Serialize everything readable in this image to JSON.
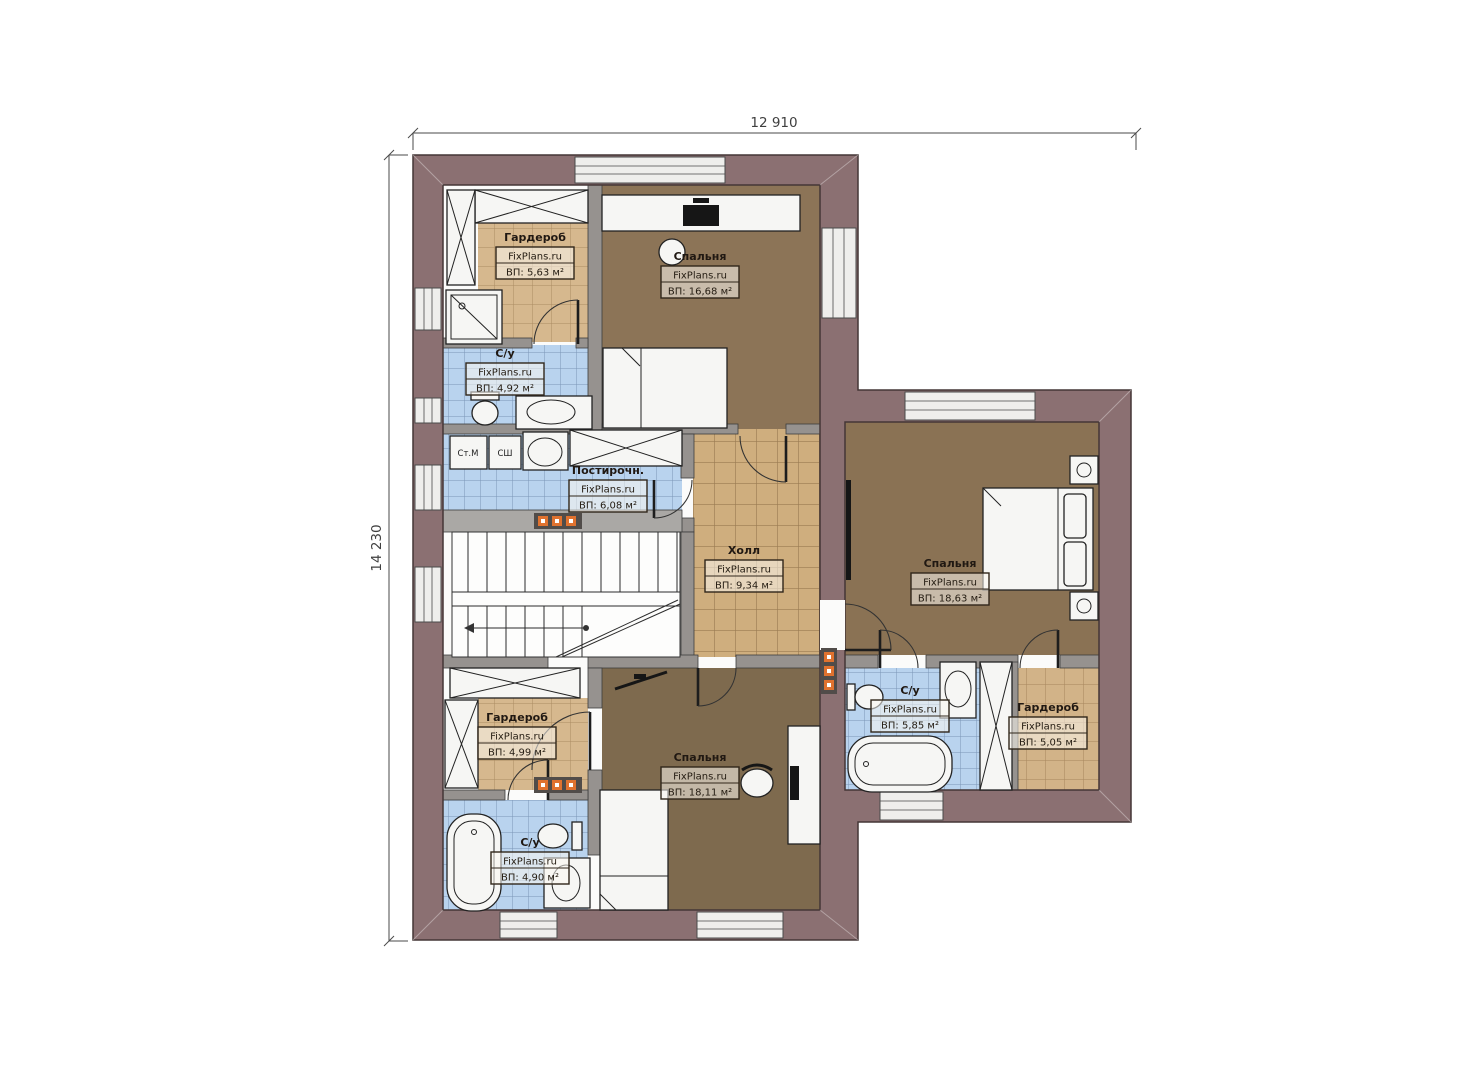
{
  "dimensions": {
    "width_label": "12 910",
    "height_label": "14 230"
  },
  "branding": "FixPlans.ru",
  "rooms": [
    {
      "id": "wardrobe-top-left",
      "name": "Гардероб",
      "brand": "FixPlans.ru",
      "area": "ВП: 5,63 м²"
    },
    {
      "id": "bedroom-top",
      "name": "Спальня",
      "brand": "FixPlans.ru",
      "area": "ВП: 16,68 м²"
    },
    {
      "id": "bathroom-left",
      "name": "С/у",
      "brand": "FixPlans.ru",
      "area": "ВП: 4,92 м²"
    },
    {
      "id": "laundry",
      "name": "Постирочн.",
      "brand": "FixPlans.ru",
      "area": "ВП: 6,08 м²"
    },
    {
      "id": "hall",
      "name": "Холл",
      "brand": "FixPlans.ru",
      "area": "ВП: 9,34 м²"
    },
    {
      "id": "bedroom-right",
      "name": "Спальня",
      "brand": "FixPlans.ru",
      "area": "ВП: 18,63 м²"
    },
    {
      "id": "bathroom-right",
      "name": "С/у",
      "brand": "FixPlans.ru",
      "area": "ВП: 5,85 м²"
    },
    {
      "id": "wardrobe-right",
      "name": "Гардероб",
      "brand": "FixPlans.ru",
      "area": "ВП: 5,05 м²"
    },
    {
      "id": "wardrobe-bottom-left",
      "name": "Гардероб",
      "brand": "FixPlans.ru",
      "area": "ВП: 4,99 м²"
    },
    {
      "id": "bedroom-bottom",
      "name": "Спальня",
      "brand": "FixPlans.ru",
      "area": "ВП: 18,11 м²"
    },
    {
      "id": "bathroom-bottom-left",
      "name": "С/у",
      "brand": "FixPlans.ru",
      "area": "ВП: 4,90 м²"
    }
  ],
  "appliances": {
    "washer": "Ст.М",
    "dryer": "СШ"
  },
  "colors": {
    "exterior_wall": "#8b7072",
    "interior_wall": "#96928f",
    "bedroom_floor": "#8a7254",
    "tile_tan": "#d6b88e",
    "tile_blue": "#b9d3ee",
    "radiator": "#e0722f"
  }
}
